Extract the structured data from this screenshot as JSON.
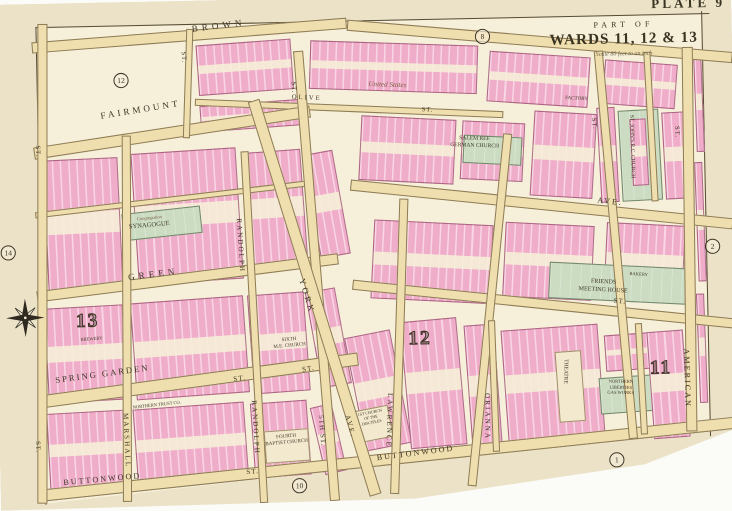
{
  "title_block": {
    "plate": "PLATE 9",
    "part_of": "PART OF",
    "wards": "WARDS 11, 12 & 13",
    "scale": "Scale 80 feet to an inch"
  },
  "ward_numbers": [
    {
      "label": "13",
      "x": 78,
      "y": 304
    },
    {
      "label": "12",
      "x": 406,
      "y": 328
    },
    {
      "label": "11",
      "x": 644,
      "y": 362
    }
  ],
  "plate_refs": [
    {
      "label": "12",
      "x": 120,
      "y": 70
    },
    {
      "label": "8",
      "x": 478,
      "y": 34
    },
    {
      "label": "2",
      "x": 701,
      "y": 246
    },
    {
      "label": "14",
      "x": 5,
      "y": 238
    },
    {
      "label": "10",
      "x": 288,
      "y": 474
    },
    {
      "label": "1",
      "x": 602,
      "y": 455
    }
  ],
  "street_labels": [
    {
      "text": "BROWN",
      "x": 198,
      "y": 24,
      "rot": -6,
      "size": 9,
      "ls": 4
    },
    {
      "text": "OLIVE",
      "x": 296,
      "y": 95,
      "rot": 4,
      "size": 6.5,
      "ls": 2
    },
    {
      "text": "ST.",
      "x": 424,
      "y": 110,
      "rot": 4,
      "size": 6.5,
      "ls": 1
    },
    {
      "text": "FAIRMOUNT",
      "x": 106,
      "y": 108,
      "rot": -8,
      "size": 9,
      "ls": 3
    },
    {
      "text": "AVE.",
      "x": 596,
      "y": 202,
      "rot": 7,
      "size": 8,
      "ls": 2
    },
    {
      "text": "GREEN",
      "x": 130,
      "y": 268,
      "rot": -6,
      "size": 9,
      "ls": 4
    },
    {
      "text": "ST.",
      "x": 610,
      "y": 302,
      "rot": 7,
      "size": 7,
      "ls": 1
    },
    {
      "text": "SPRING GARDEN",
      "x": 56,
      "y": 368,
      "rot": -6.5,
      "size": 8.5,
      "ls": 2
    },
    {
      "text": "ST.",
      "x": 232,
      "y": 372,
      "rot": -6.5,
      "size": 7,
      "ls": 1
    },
    {
      "text": "ST.",
      "x": 300,
      "y": 364,
      "rot": -8,
      "size": 7,
      "ls": 1
    },
    {
      "text": "BUTTONWOOD",
      "x": 62,
      "y": 470,
      "rot": -4,
      "size": 8,
      "ls": 2
    },
    {
      "text": "ST.",
      "x": 243,
      "y": 464,
      "rot": -4,
      "size": 7,
      "ls": 1
    },
    {
      "text": "BUTTONWOOD",
      "x": 372,
      "y": 452,
      "rot": -6,
      "size": 8,
      "ls": 2
    },
    {
      "text": "ST.",
      "x": 192,
      "y": 50,
      "rot": 87,
      "size": 6.5,
      "ls": 1
    },
    {
      "text": "ST.",
      "x": 46,
      "y": 140,
      "rot": 89,
      "size": 6.5,
      "ls": 1
    },
    {
      "text": "ST.",
      "x": 40,
      "y": 432,
      "rot": 89,
      "size": 6.5,
      "ls": 1
    },
    {
      "text": "MARSHALL",
      "x": 128,
      "y": 406,
      "rot": 88.5,
      "size": 7,
      "ls": 2
    },
    {
      "text": "RANDOLPH",
      "x": 244,
      "y": 216,
      "rot": 87.5,
      "size": 7,
      "ls": 2
    },
    {
      "text": "RANDOLPH",
      "x": 255,
      "y": 396,
      "rot": 87.5,
      "size": 7,
      "ls": 2
    },
    {
      "text": "ST.",
      "x": 300,
      "y": 82,
      "rot": 86.5,
      "size": 6.5,
      "ls": 1
    },
    {
      "text": "5TH ST.",
      "x": 321,
      "y": 412,
      "rot": 86.5,
      "size": 7,
      "ls": 1
    },
    {
      "text": "YORK",
      "x": 306,
      "y": 276,
      "rot": 74,
      "size": 8.5,
      "ls": 3
    },
    {
      "text": "AVE.",
      "x": 347,
      "y": 412,
      "rot": 76,
      "size": 7,
      "ls": 2
    },
    {
      "text": "LAWRENCE",
      "x": 390,
      "y": 392,
      "rot": 93,
      "size": 7,
      "ls": 2
    },
    {
      "text": "ORIANNA",
      "x": 486,
      "y": 394,
      "rot": 91,
      "size": 7,
      "ls": 2
    },
    {
      "text": "ST.",
      "x": 596,
      "y": 124,
      "rot": 86,
      "size": 6.5,
      "ls": 1
    },
    {
      "text": "ST.",
      "x": 678,
      "y": 134,
      "rot": 89,
      "size": 6.5,
      "ls": 1
    },
    {
      "text": "AMERICAN",
      "x": 684,
      "y": 354,
      "rot": 89.5,
      "size": 8,
      "ls": 2
    }
  ],
  "landmark_labels": [
    {
      "lines": [
        "United States"
      ],
      "x": 372,
      "y": 82,
      "rot": 3,
      "size": 7,
      "cls": "script"
    },
    {
      "lines": [
        "FACTORY"
      ],
      "x": 566,
      "y": 102,
      "rot": 4,
      "size": 5
    },
    {
      "lines": [
        "SALEM REF.",
        "GERMAN CHURCH"
      ],
      "x": 452,
      "y": 138,
      "rot": 3,
      "size": 5.5
    },
    {
      "lines": [
        "ST. JOHN'S R.C. CHURCH"
      ],
      "x": 634,
      "y": 122,
      "rot": 90,
      "size": 5.5
    },
    {
      "lines": [
        "Congregation"
      ],
      "x": 140,
      "y": 212,
      "rot": -4,
      "size": 4.5,
      "cls": "script"
    },
    {
      "lines": [
        "SYNAGOGUE"
      ],
      "x": 132,
      "y": 219,
      "rot": -4,
      "size": 6.5
    },
    {
      "lines": [
        "FRIENDS",
        "MEETING HOUSE"
      ],
      "x": 576,
      "y": 282,
      "rot": 4,
      "size": 6
    },
    {
      "lines": [
        "BAKERY"
      ],
      "x": 626,
      "y": 276,
      "rot": 5,
      "size": 4.5
    },
    {
      "lines": [
        "SIXTH",
        "M.E. CHURCH"
      ],
      "x": 272,
      "y": 336,
      "rot": -4,
      "size": 5
    },
    {
      "lines": [
        "BREWERY"
      ],
      "x": 82,
      "y": 330,
      "rot": -3,
      "size": 4.5
    },
    {
      "lines": [
        "FOURTH",
        "BAPTIST CHURCH"
      ],
      "x": 262,
      "y": 432,
      "rot": -4,
      "size": 5
    },
    {
      "lines": [
        "NORTHERN TRUST CO."
      ],
      "x": 132,
      "y": 398,
      "rot": -5,
      "size": 4.5
    },
    {
      "lines": [
        "1ST CHURCH",
        "OF THE",
        "DISCIPLES"
      ],
      "x": 354,
      "y": 410,
      "rot": -10,
      "size": 4
    },
    {
      "lines": [
        "NORTHERN",
        "LIBERTIES",
        "GAS WORKS"
      ],
      "x": 602,
      "y": 382,
      "rot": 2,
      "size": 4.5
    },
    {
      "lines": [
        "THEATRE"
      ],
      "x": 564,
      "y": 362,
      "rot": 92,
      "size": 5.5
    }
  ],
  "map_colors": {
    "paper": "#ebe2c7",
    "map_background": "#f6efd9",
    "street": "#f0dfae",
    "building_block": "#f0adc9",
    "public_building": "#cbdcc3",
    "ink": "#3e3527"
  }
}
